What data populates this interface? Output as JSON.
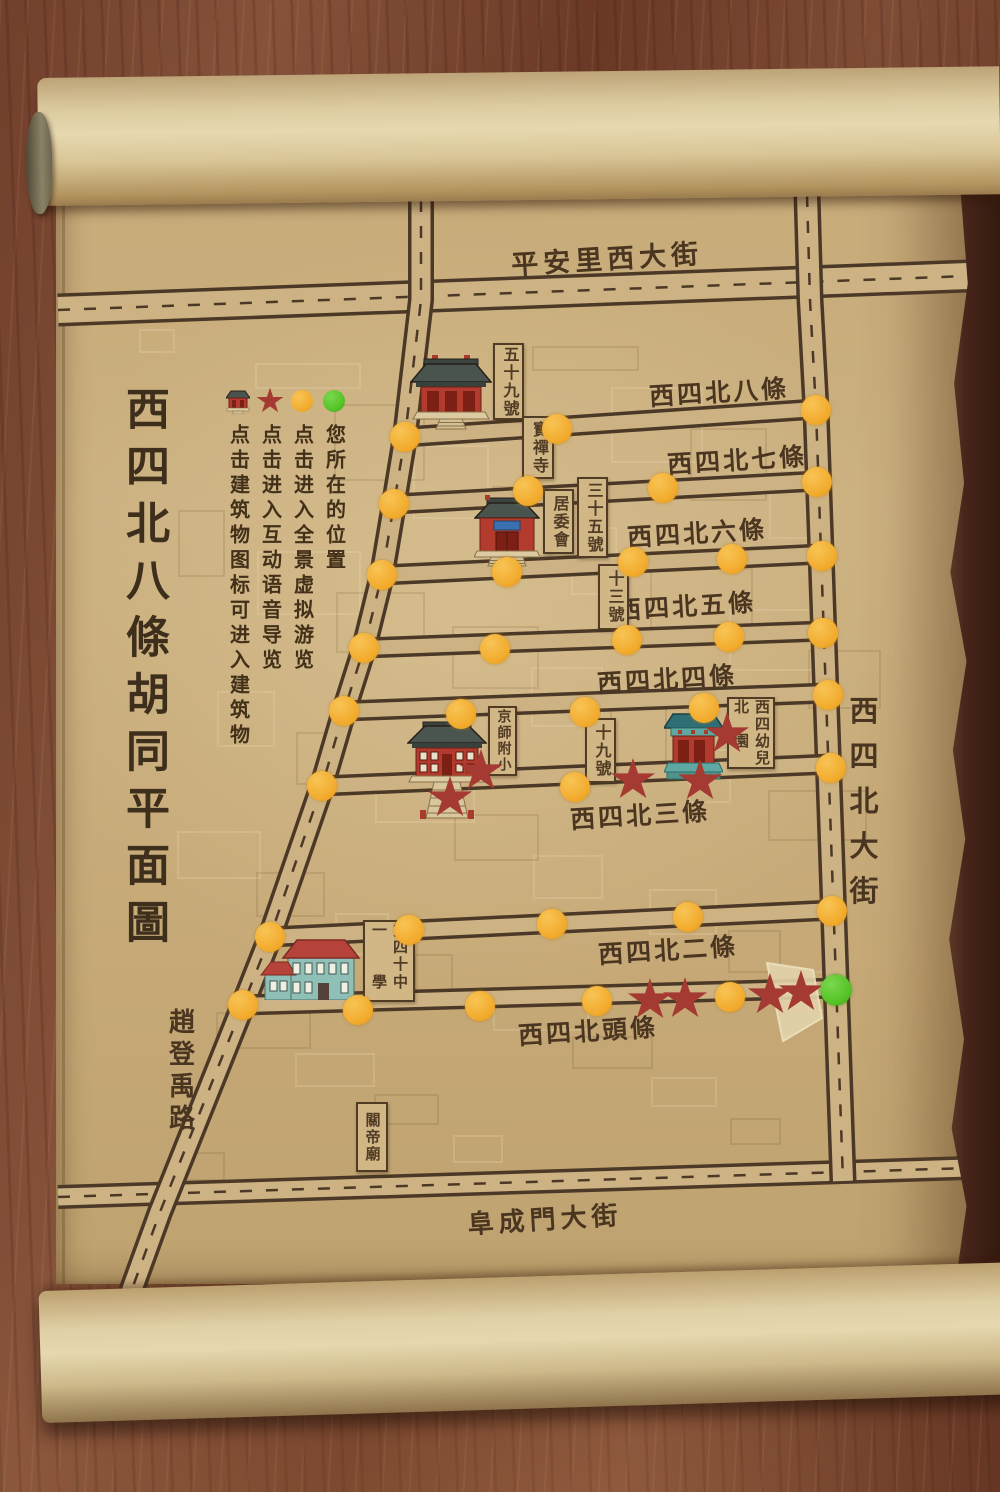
{
  "title": "西四北八條胡同平面圖",
  "legend": {
    "items": [
      {
        "icon": "building-icon",
        "label": "点击建筑物图标可进入建筑物"
      },
      {
        "icon": "audio-star-icon",
        "label": "点击进入互动语音导览"
      },
      {
        "icon": "panorama-dot-icon",
        "label": "点击进入全景虚拟游览"
      },
      {
        "icon": "location-dot-icon",
        "label": "您所在的位置"
      }
    ]
  },
  "colors": {
    "panorama_dot": "#f2ab2d",
    "audio_star": "#a43a31",
    "location_dot": "#54c226",
    "paper": "#c9ad7c",
    "road_line": "#4b3826"
  },
  "street_labels": [
    {
      "text": "平安里西大街",
      "x": 607,
      "y": 257,
      "orient": "h",
      "fs": 27,
      "ls": 5
    },
    {
      "text": "阜成門大街",
      "x": 545,
      "y": 1218,
      "orient": "h",
      "fs": 26,
      "ls": 5
    },
    {
      "text": "西四北大街",
      "x": 861,
      "y": 808,
      "orient": "v",
      "fs": 29,
      "ls": 16
    },
    {
      "text": "趙登禹路",
      "x": 180,
      "y": 1072,
      "orient": "v",
      "fs": 26,
      "ls": 6
    }
  ],
  "hutong_labels": [
    {
      "text": "西四北八條",
      "x": 719,
      "y": 391
    },
    {
      "text": "西四北七條",
      "x": 737,
      "y": 459
    },
    {
      "text": "西四北六條",
      "x": 697,
      "y": 532
    },
    {
      "text": "西四北五條",
      "x": 686,
      "y": 605
    },
    {
      "text": "西四北四條",
      "x": 667,
      "y": 678
    },
    {
      "text": "西四北三條",
      "x": 640,
      "y": 814
    },
    {
      "text": "西四北二條",
      "x": 668,
      "y": 949
    },
    {
      "text": "西四北頭條",
      "x": 588,
      "y": 1030
    }
  ],
  "building_labels": [
    {
      "lines": [
        "五十九號"
      ],
      "x": 493,
      "y": 343,
      "w": 27,
      "h": 73,
      "fs": 16
    },
    {
      "lines": [
        "寶禪寺"
      ],
      "x": 522,
      "y": 416,
      "w": 28,
      "h": 59,
      "fs": 16
    },
    {
      "lines": [
        "居委會"
      ],
      "x": 543,
      "y": 489,
      "w": 27,
      "h": 61,
      "fs": 16
    },
    {
      "lines": [
        "三十五號"
      ],
      "x": 577,
      "y": 477,
      "w": 27,
      "h": 77,
      "fs": 16
    },
    {
      "lines": [
        "十三號"
      ],
      "x": 598,
      "y": 564,
      "w": 27,
      "h": 62,
      "fs": 16
    },
    {
      "lines": [
        "京師附小"
      ],
      "x": 488,
      "y": 706,
      "w": 25,
      "h": 66,
      "fs": 14
    },
    {
      "lines": [
        "十九號"
      ],
      "x": 585,
      "y": 718,
      "w": 27,
      "h": 61,
      "fs": 16
    },
    {
      "lines": [
        "西四北",
        "幼兒園"
      ],
      "x": 727,
      "y": 697,
      "w": 44,
      "h": 68,
      "fs": 15
    },
    {
      "lines": [
        "第四十一",
        "中學"
      ],
      "x": 363,
      "y": 920,
      "w": 48,
      "h": 78,
      "fs": 15
    },
    {
      "lines": [
        "關帝廟"
      ],
      "x": 356,
      "y": 1102,
      "w": 28,
      "h": 66,
      "fs": 15
    }
  ],
  "markers": {
    "panorama_points": [
      [
        405,
        437
      ],
      [
        394,
        504
      ],
      [
        382,
        575
      ],
      [
        364,
        648
      ],
      [
        344,
        711
      ],
      [
        322,
        786
      ],
      [
        270,
        937
      ],
      [
        243,
        1005
      ],
      [
        557,
        429
      ],
      [
        816,
        410
      ],
      [
        528,
        491
      ],
      [
        663,
        488
      ],
      [
        817,
        482
      ],
      [
        507,
        572
      ],
      [
        633,
        562
      ],
      [
        732,
        559
      ],
      [
        822,
        556
      ],
      [
        495,
        649
      ],
      [
        627,
        640
      ],
      [
        729,
        637
      ],
      [
        823,
        633
      ],
      [
        461,
        714
      ],
      [
        585,
        712
      ],
      [
        704,
        708
      ],
      [
        828,
        695
      ],
      [
        575,
        787
      ],
      [
        831,
        768
      ],
      [
        409,
        930
      ],
      [
        552,
        924
      ],
      [
        688,
        917
      ],
      [
        832,
        911
      ],
      [
        358,
        1010
      ],
      [
        480,
        1006
      ],
      [
        597,
        1001
      ],
      [
        730,
        997
      ]
    ],
    "audio_points": [
      [
        450,
        798
      ],
      [
        481,
        771
      ],
      [
        633,
        780
      ],
      [
        700,
        781
      ],
      [
        727,
        734
      ],
      [
        650,
        1000
      ],
      [
        685,
        999
      ],
      [
        770,
        995
      ],
      [
        801,
        992
      ]
    ],
    "current_location": [
      836,
      990
    ]
  }
}
